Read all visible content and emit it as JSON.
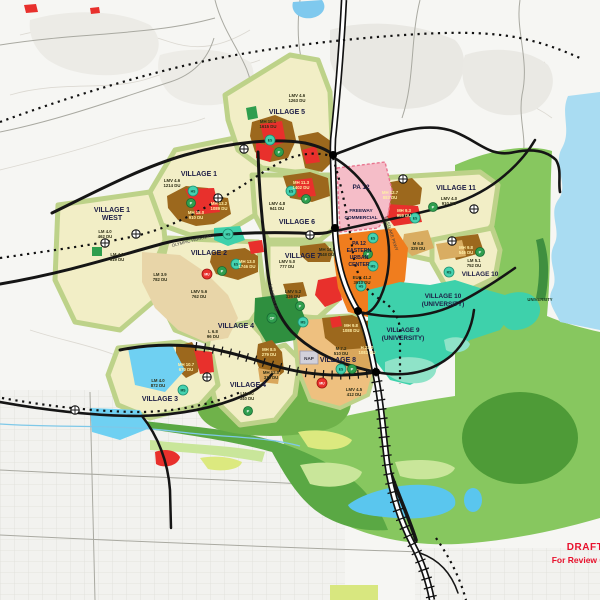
{
  "draft": {
    "line1": "DRAFT",
    "line2": "For Review Only"
  },
  "nap_label": "NAP",
  "palette": {
    "village_residential": "#f2eec6",
    "village_edge_olive": "#bdd289",
    "low_medium_tan": "#e8d5a8",
    "medium_tan": "#d9ad62",
    "medium_high_brown": "#9c681d",
    "high_density_red": "#e8302c",
    "village8_core_tan": "#eec07f",
    "freeway_commercial_pink": "#f5bdc8",
    "euc_orange": "#f07d1e",
    "university_teal": "#3ed1ab",
    "open_space_bright_green": "#87c75f",
    "open_space_medium_green": "#5aa844",
    "park_dark_green": "#2f9e4e",
    "reservoir_blue": "#a9dcf2",
    "pond_blue": "#5ac6ee",
    "road_black": "#151515",
    "draft_red": "#e8112d"
  },
  "map": {
    "villages": [
      {
        "id": "village-1-west",
        "lines": [
          "VILLAGE 1",
          "WEST"
        ],
        "x": 112,
        "y": 212
      },
      {
        "id": "village-1",
        "lines": [
          "VILLAGE 1"
        ],
        "x": 199,
        "y": 176
      },
      {
        "id": "village-5",
        "lines": [
          "VILLAGE 5"
        ],
        "x": 287,
        "y": 114
      },
      {
        "id": "village-6",
        "lines": [
          "VILLAGE 6"
        ],
        "x": 297,
        "y": 224
      },
      {
        "id": "village-2",
        "lines": [
          "VILLAGE 2"
        ],
        "x": 209,
        "y": 255
      },
      {
        "id": "village-7",
        "lines": [
          "VILLAGE 7"
        ],
        "x": 303,
        "y": 258
      },
      {
        "id": "village-4",
        "lines": [
          "VILLAGE 4"
        ],
        "x": 236,
        "y": 328
      },
      {
        "id": "village-4-south",
        "lines": [
          "VILLAGE 4"
        ],
        "x": 248,
        "y": 387
      },
      {
        "id": "village-3",
        "lines": [
          "VILLAGE 3"
        ],
        "x": 160,
        "y": 401
      },
      {
        "id": "village-8",
        "lines": [
          "VILLAGE 8"
        ],
        "x": 338,
        "y": 362
      },
      {
        "id": "pa-12",
        "lines": [
          "PA 12"
        ],
        "x": 361,
        "y": 189,
        "size": 6.4
      },
      {
        "id": "freeway-commercial",
        "lines": [
          "FREEWAY",
          "COMMERCIAL"
        ],
        "x": 361,
        "y": 212,
        "size": 4.8,
        "gap": 7
      },
      {
        "id": "pa-12-euc",
        "lines": [
          "PA 12",
          "EASTERN",
          "URBAN",
          "CENTER"
        ],
        "x": 359,
        "y": 245,
        "size": 5.2,
        "gap": 7
      },
      {
        "id": "village-9-university",
        "lines": [
          "VILLAGE 9",
          "(UNIVERSITY)"
        ],
        "x": 403,
        "y": 332,
        "size": 6.4
      },
      {
        "id": "village-10-university",
        "lines": [
          "VILLAGE 10",
          "(UNIVERSITY)"
        ],
        "x": 443,
        "y": 298,
        "size": 6.4
      },
      {
        "id": "village-10",
        "lines": [
          "VILLAGE 10"
        ],
        "x": 480,
        "y": 276,
        "size": 6.4
      },
      {
        "id": "village-11",
        "lines": [
          "VILLAGE 11"
        ],
        "x": 456,
        "y": 190
      },
      {
        "id": "university",
        "lines": [
          "UNIVERSITY"
        ],
        "x": 540,
        "y": 301,
        "size": 4.2,
        "color": "#14381c"
      }
    ],
    "parcels": [
      {
        "code": "LM 4.0",
        "du": "462 DU",
        "x": 105,
        "y": 233
      },
      {
        "code": "LM 4.0",
        "du": "619 DU",
        "x": 117,
        "y": 256
      },
      {
        "code": "LM 3.9",
        "du": "782 DU",
        "x": 160,
        "y": 276
      },
      {
        "code": "LMV 4.6",
        "du": "1214 DU",
        "x": 172,
        "y": 182
      },
      {
        "code": "MH 18.0",
        "du": "910 DU",
        "x": 196,
        "y": 214,
        "light": true
      },
      {
        "code": "MH 13.2",
        "du": "1089 DU",
        "x": 219,
        "y": 205,
        "light": true
      },
      {
        "code": "LMV 4.6",
        "du": "1263 DU",
        "x": 297,
        "y": 97
      },
      {
        "code": "MH 10.1",
        "du": "1615 DU",
        "x": 268,
        "y": 123
      },
      {
        "code": "MH 11.3",
        "du": "1402 DU",
        "x": 301,
        "y": 184,
        "light": true
      },
      {
        "code": "LMV 4.8",
        "du": "941 DU",
        "x": 277,
        "y": 205
      },
      {
        "code": "MH 13.0",
        "du": "1746 DU",
        "x": 247,
        "y": 263,
        "light": true
      },
      {
        "code": "LMV 5.6",
        "du": "762 DU",
        "x": 199,
        "y": 293
      },
      {
        "code": "LMV 5.0",
        "du": "777 DU",
        "x": 287,
        "y": 263
      },
      {
        "code": "LMV 5.2",
        "du": "336 DU",
        "x": 293,
        "y": 293
      },
      {
        "code": "MH 14.5",
        "du": "448 DU",
        "x": 327,
        "y": 251
      },
      {
        "code": "L 6.8",
        "du": "96 DU",
        "x": 213,
        "y": 333
      },
      {
        "code": "MH 8.5",
        "du": "279 DU",
        "x": 269,
        "y": 351,
        "light": true
      },
      {
        "code": "MH 12.0",
        "du": "315 DU",
        "x": 271,
        "y": 374
      },
      {
        "code": "LM 4.0",
        "du": "340 DU",
        "x": 247,
        "y": 395
      },
      {
        "code": "LM 4.0",
        "du": "872 DU",
        "x": 158,
        "y": 382
      },
      {
        "code": "MH 10.7",
        "du": "670 DU",
        "x": 186,
        "y": 366,
        "light": true
      },
      {
        "code": "M 7.2",
        "du": "510 DU",
        "x": 341,
        "y": 350
      },
      {
        "code": "H 23.0",
        "du": "1083 DU",
        "x": 367,
        "y": 349,
        "light": true
      },
      {
        "code": "MH 9.8",
        "du": "1088 DU",
        "x": 351,
        "y": 327,
        "light": true
      },
      {
        "code": "LMV 4.5",
        "du": "412 DU",
        "x": 354,
        "y": 391
      },
      {
        "code": "MH 12.7",
        "du": "883 DU",
        "x": 390,
        "y": 194,
        "light": true
      },
      {
        "code": "MH 9.3",
        "du": "959 DU",
        "x": 404,
        "y": 212,
        "light": true
      },
      {
        "code": "LMV 4.0",
        "du": "910 DU",
        "x": 449,
        "y": 200
      },
      {
        "code": "M 6.8",
        "du": "329 DU",
        "x": 418,
        "y": 245
      },
      {
        "code": "MH 9.8",
        "du": "546 DU",
        "x": 466,
        "y": 249,
        "light": true
      },
      {
        "code": "LM 5.1",
        "du": "752 DU",
        "x": 474,
        "y": 262
      },
      {
        "code": "EUC 41.2",
        "du": "3910 DU",
        "x": 362,
        "y": 279
      }
    ],
    "road_labels": [
      {
        "text": "OLYMPIC PARKWAY",
        "x": 192,
        "y": 242,
        "angle": -14
      },
      {
        "text": "LA MEDIA RD",
        "x": 272,
        "y": 298,
        "angle": 78
      },
      {
        "text": "EASTLAKE PKWY",
        "x": 390,
        "y": 234,
        "angle": 72
      }
    ],
    "symbols": [
      {
        "t": "HS",
        "k": "school",
        "x": 193,
        "y": 191
      },
      {
        "t": "P",
        "k": "park",
        "x": 191,
        "y": 203
      },
      {
        "t": "ES",
        "k": "school",
        "x": 270,
        "y": 140
      },
      {
        "t": "P",
        "k": "park",
        "x": 279,
        "y": 152
      },
      {
        "t": "ES",
        "k": "school",
        "x": 291,
        "y": 191
      },
      {
        "t": "P",
        "k": "park",
        "x": 306,
        "y": 199
      },
      {
        "t": "HS",
        "k": "school",
        "x": 228,
        "y": 234
      },
      {
        "t": "ES",
        "k": "school",
        "x": 236,
        "y": 264
      },
      {
        "t": "P",
        "k": "park",
        "x": 222,
        "y": 271
      },
      {
        "t": "MU",
        "k": "mixed",
        "x": 207,
        "y": 274
      },
      {
        "t": "P",
        "k": "park",
        "x": 300,
        "y": 306
      },
      {
        "t": "CP",
        "k": "park",
        "x": 272,
        "y": 318
      },
      {
        "t": "P",
        "k": "park",
        "x": 248,
        "y": 411
      },
      {
        "t": "MS",
        "k": "school",
        "x": 183,
        "y": 390
      },
      {
        "t": "MS",
        "k": "school",
        "x": 303,
        "y": 322
      },
      {
        "t": "ES",
        "k": "school",
        "x": 341,
        "y": 369
      },
      {
        "t": "P",
        "k": "park",
        "x": 352,
        "y": 369
      },
      {
        "t": "MU",
        "k": "mixed",
        "x": 322,
        "y": 383
      },
      {
        "t": "ES",
        "k": "school",
        "x": 373,
        "y": 238
      },
      {
        "t": "P",
        "k": "park",
        "x": 368,
        "y": 254
      },
      {
        "t": "MS",
        "k": "school",
        "x": 373,
        "y": 266
      },
      {
        "t": "HS",
        "k": "school",
        "x": 361,
        "y": 286
      },
      {
        "t": "ES",
        "k": "school",
        "x": 415,
        "y": 218
      },
      {
        "t": "P",
        "k": "park",
        "x": 433,
        "y": 207
      },
      {
        "t": "P",
        "k": "park",
        "x": 480,
        "y": 252
      },
      {
        "t": "RS",
        "k": "school",
        "x": 449,
        "y": 272
      }
    ],
    "interchanges": [
      {
        "x": 105,
        "y": 243
      },
      {
        "x": 136,
        "y": 234
      },
      {
        "x": 218,
        "y": 198
      },
      {
        "x": 244,
        "y": 149
      },
      {
        "x": 403,
        "y": 179
      },
      {
        "x": 452,
        "y": 241
      },
      {
        "x": 474,
        "y": 209
      },
      {
        "x": 207,
        "y": 377
      },
      {
        "x": 310,
        "y": 235
      },
      {
        "x": 75,
        "y": 410
      }
    ],
    "junction_dots": [
      {
        "x": 333,
        "y": 155
      },
      {
        "x": 335,
        "y": 228
      },
      {
        "x": 358,
        "y": 311
      },
      {
        "x": 376,
        "y": 372
      }
    ]
  }
}
